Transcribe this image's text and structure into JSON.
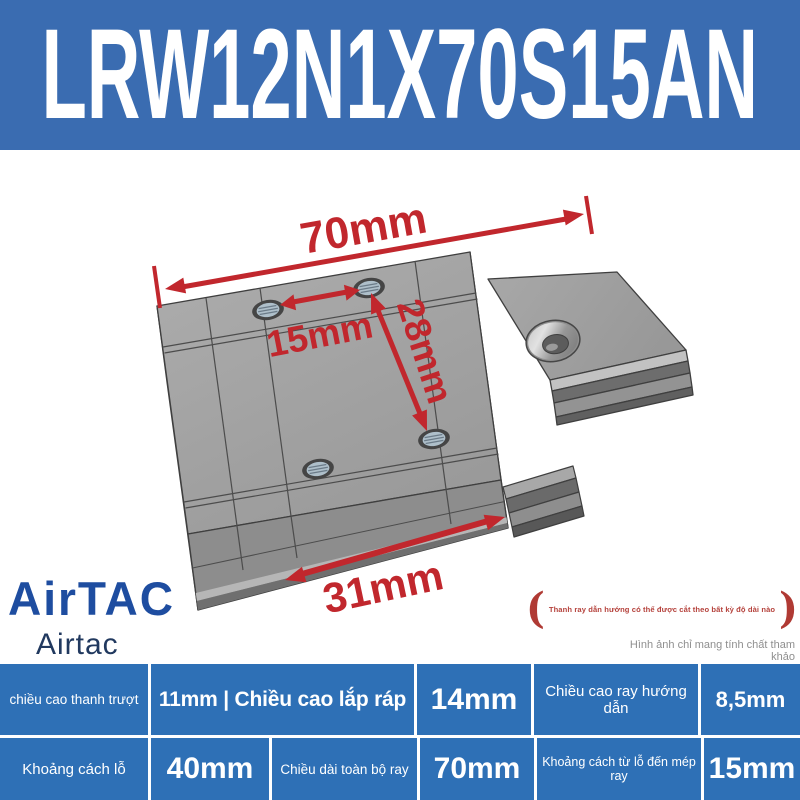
{
  "header": {
    "title": "LRW12N1X70S15AN"
  },
  "colors": {
    "banner_blue": "#3a6cb1",
    "table_blue": "#2e70b6",
    "dimension_red": "#c1272d",
    "logo_blue": "#1e4da0"
  },
  "diagram": {
    "dimensions": {
      "rail_length": "70mm",
      "hole_spacing": "15mm",
      "hole_diagonal": "28mm",
      "block_width": "31mm"
    }
  },
  "notes": {
    "bracket_open": "(",
    "rail_cut": "Thanh ray dẫn hướng có thể được cắt theo bất kỳ độ dài nào",
    "bracket_close": ")",
    "reference": "Hình ảnh chỉ mang tính chất tham khảo"
  },
  "brand": {
    "logo": "AirTAC",
    "name": "Airtac"
  },
  "spec_table": {
    "row1": [
      {
        "text": "chiều cao thanh trượt"
      },
      {
        "text": "11mm | Chiều cao lắp ráp"
      },
      {
        "text": "14mm"
      },
      {
        "text": "Chiều cao ray hướng dẫn"
      },
      {
        "text": "8,5mm"
      }
    ],
    "row2": [
      {
        "text": "Khoảng cách lỗ"
      },
      {
        "text": "40mm"
      },
      {
        "text": "Chiều dài toàn bộ ray"
      },
      {
        "text": "70mm"
      },
      {
        "text": "Khoảng cách từ lỗ đến mép ray"
      },
      {
        "text": "15mm"
      }
    ]
  }
}
